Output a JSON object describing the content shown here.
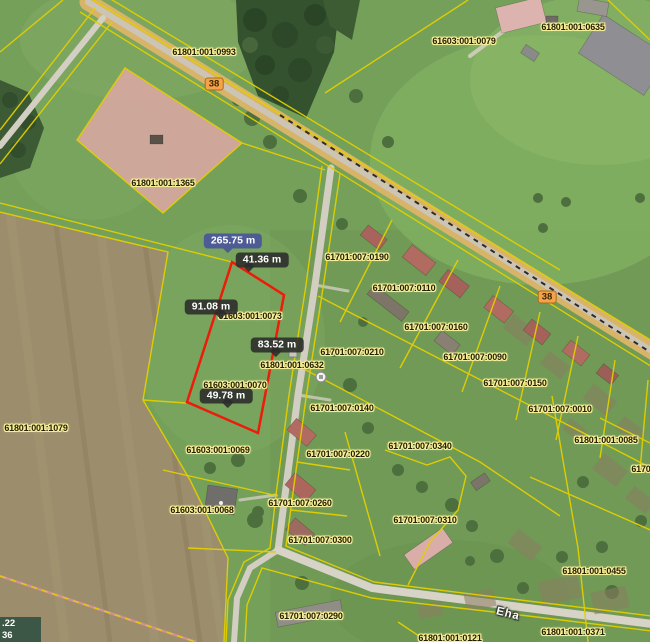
{
  "map": {
    "description": "cadastral-aerial-map-with-measurement",
    "parcel_labels": [
      {
        "text": "61801:001:0993",
        "x": 204,
        "y": 52
      },
      {
        "text": "61603:001:0079",
        "x": 464,
        "y": 41
      },
      {
        "text": "61801:001:0635",
        "x": 573,
        "y": 27
      },
      {
        "text": "61801:001:1365",
        "x": 163,
        "y": 183
      },
      {
        "text": "61701:007:0190",
        "x": 357,
        "y": 257
      },
      {
        "text": "61701:007:0110",
        "x": 404,
        "y": 288
      },
      {
        "text": "61701:007:0160",
        "x": 436,
        "y": 327
      },
      {
        "text": "61701:007:0210",
        "x": 352,
        "y": 352
      },
      {
        "text": "61701:007:0090",
        "x": 475,
        "y": 357
      },
      {
        "text": "61701:007:0150",
        "x": 515,
        "y": 383
      },
      {
        "text": "61701:007:0010",
        "x": 560,
        "y": 409
      },
      {
        "text": "61801:001:0085",
        "x": 606,
        "y": 440
      },
      {
        "text": "61701:007",
        "x": 652,
        "y": 469
      },
      {
        "text": "61801:001:0632",
        "x": 292,
        "y": 365
      },
      {
        "text": "61603:001:0073",
        "x": 250,
        "y": 316
      },
      {
        "text": "61603:001:0070",
        "x": 235,
        "y": 385
      },
      {
        "text": "61701:007:0140",
        "x": 342,
        "y": 408
      },
      {
        "text": "61701:007:0340",
        "x": 420,
        "y": 446
      },
      {
        "text": "61603:001:0069",
        "x": 218,
        "y": 450
      },
      {
        "text": "61701:007:0220",
        "x": 338,
        "y": 454
      },
      {
        "text": "61603:001:0068",
        "x": 202,
        "y": 510
      },
      {
        "text": "61701:007:0260",
        "x": 300,
        "y": 503
      },
      {
        "text": "61701:007:0300",
        "x": 320,
        "y": 540
      },
      {
        "text": "61701:007:0310",
        "x": 425,
        "y": 520
      },
      {
        "text": "61801:001:0455",
        "x": 594,
        "y": 571
      },
      {
        "text": "61701:007:0290",
        "x": 311,
        "y": 616
      },
      {
        "text": "61801:001:0121",
        "x": 450,
        "y": 638
      },
      {
        "text": "61801:001:0371",
        "x": 573,
        "y": 632
      },
      {
        "text": "61801:001:1079",
        "x": 36,
        "y": 428
      }
    ],
    "road_badges": [
      {
        "text": "38",
        "x": 214,
        "y": 84
      },
      {
        "text": "38",
        "x": 547,
        "y": 297
      }
    ],
    "street_label": {
      "text": "Eha",
      "x": 508,
      "y": 614
    },
    "measurement": {
      "total": {
        "label": "265.75 m",
        "x": 233,
        "y": 241,
        "tail": 35
      },
      "segments": [
        {
          "label": "41.36 m",
          "x": 262,
          "y": 260,
          "tail": 18
        },
        {
          "label": "91.08 m",
          "x": 211,
          "y": 307,
          "tail": 60
        },
        {
          "label": "83.52 m",
          "x": 277,
          "y": 345,
          "tail": 40
        },
        {
          "label": "49.78 m",
          "x": 226,
          "y": 396,
          "tail": 45
        }
      ],
      "polygon_points": "232,262 284,295 258,433 187,402"
    },
    "coord_overlay": {
      "line1": ".22",
      "line2": "36"
    },
    "colors": {
      "boundary_line": "#e3cf00",
      "measure_line": "#ed1c09",
      "badge_dark": "rgba(43,43,43,0.88)",
      "badge_total": "#4d5c95",
      "road_badge_bg": "#f3a44a",
      "label_halo": "#f6ef9a",
      "highlight_parcel_fill": "#d8a8a2"
    }
  }
}
